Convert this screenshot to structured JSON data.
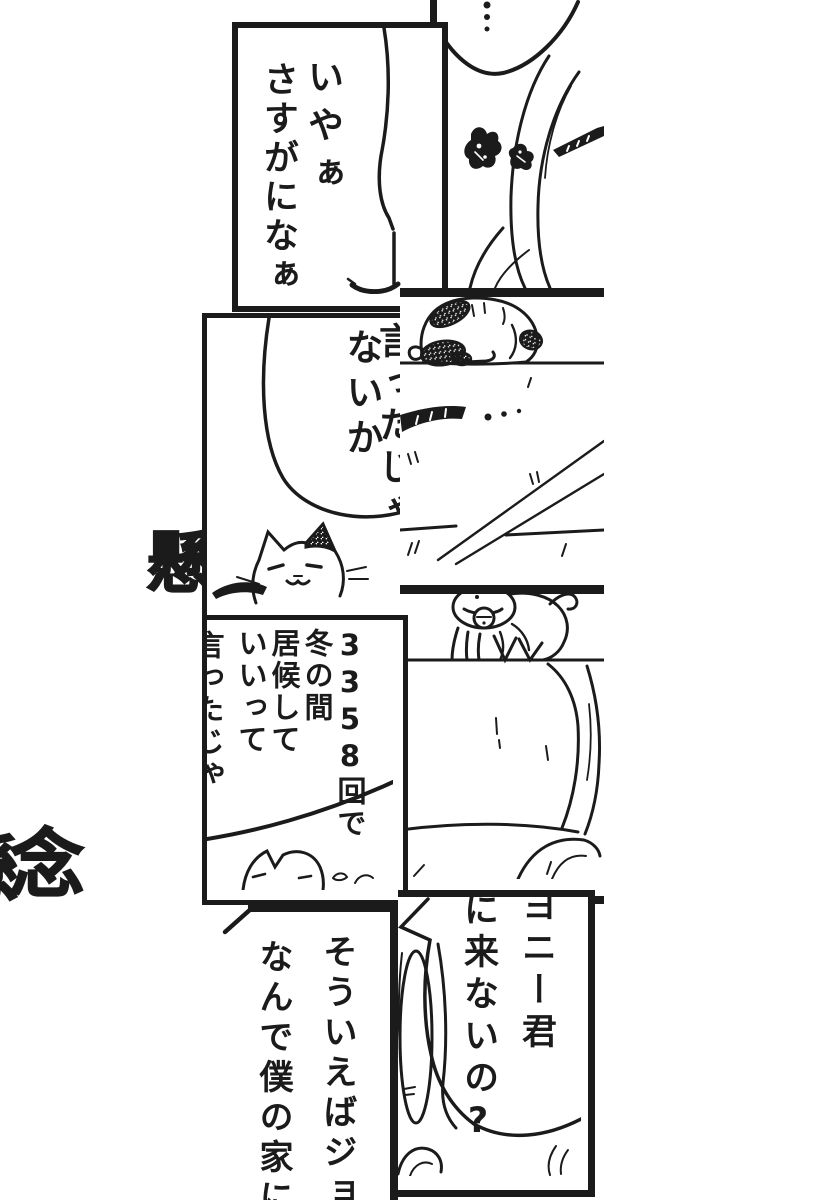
{
  "colors": {
    "ink": "#1b1b1b",
    "paper": "#ffffff"
  },
  "panels": {
    "top_right": {
      "ellipsis": "…"
    },
    "top_left": {
      "line1": "いやぁ",
      "line2": "さすがになぁ‥"
    },
    "mid_left": {
      "line1": "言ったじゃ",
      "line2": "ないか"
    },
    "count": {
      "lines": [
        "3358回で",
        "冬の間",
        "居候して",
        "いいって",
        "言ったじゃ"
      ]
    },
    "bottom_left": {
      "line1": "そういえばジョ",
      "line2": "なんで僕の家に"
    },
    "bottom_right": {
      "line1": "ヨニー君",
      "line2": "に来ないの?"
    }
  },
  "sfx": {
    "top": "懸",
    "bottom": "念",
    "edge": "懸"
  }
}
